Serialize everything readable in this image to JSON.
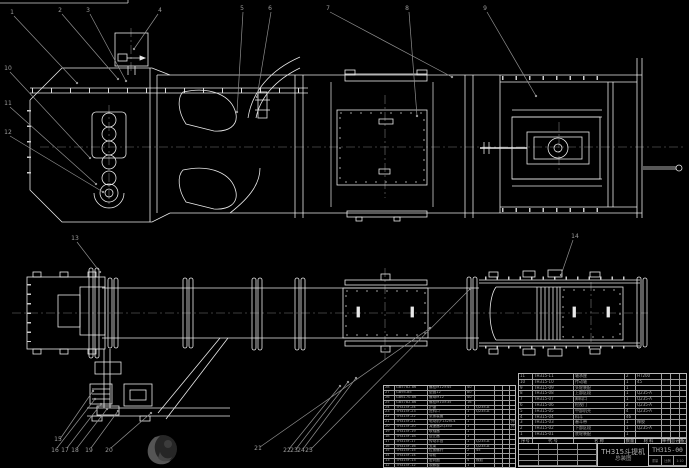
{
  "app": {
    "kind": "CAD assembly drawing of bucket elevator",
    "background": "#000000"
  },
  "drawing": {
    "title": "TH315斗提机",
    "subtitle": "总装图",
    "drawing_no": "TH315-00",
    "scale_rows": [
      [
        "重量",
        "比例",
        "1:10"
      ]
    ]
  },
  "bom_right": {
    "header_rows": [
      [
        "序号",
        "代 号",
        "名 称",
        "数量",
        "材 料",
        "单件",
        "总计",
        "备注"
      ]
    ],
    "rows": [
      [
        "11",
        "TH315-11",
        "轴承座",
        "2",
        "HT200",
        "",
        "",
        ""
      ],
      [
        "10",
        "TH315-10",
        "传动轴",
        "1",
        "45",
        "",
        "",
        ""
      ],
      [
        "9",
        "TH315-09",
        "头轮装配",
        "1",
        "",
        "",
        "",
        ""
      ],
      [
        "8",
        "TH315-08",
        "上部区段",
        "1",
        "Q235-A",
        "",
        "",
        ""
      ],
      [
        "7",
        "TH315-07",
        "卸料口",
        "1",
        "Q235-A",
        "",
        "",
        ""
      ],
      [
        "6",
        "TH315-06",
        "检视门",
        "2",
        "Q235-A",
        "",
        "",
        ""
      ],
      [
        "5",
        "TH315-05",
        "中部机壳",
        "4",
        "Q235-A",
        "",
        "",
        ""
      ],
      [
        "4",
        "TH315-04",
        "料斗",
        "46",
        "",
        "",
        "",
        ""
      ],
      [
        "3",
        "TH315-03",
        "畚斗带",
        "1",
        "橡胶",
        "",
        "",
        ""
      ],
      [
        "2",
        "TH315-02",
        "下部区段",
        "1",
        "Q235-A",
        "",
        "",
        ""
      ],
      [
        "1",
        "TH315-01",
        "底轮装配",
        "1",
        "",
        "",
        "",
        ""
      ]
    ]
  },
  "bom_left": {
    "rows": [
      [
        "28",
        "GB5782-86",
        "螺栓M12×45",
        "40",
        "",
        "",
        "",
        ""
      ],
      [
        "27",
        "GB95-85",
        "垫圈12",
        "80",
        "",
        "",
        "",
        ""
      ],
      [
        "26",
        "GB6170-86",
        "螺母M12",
        "40",
        "",
        "",
        "",
        ""
      ],
      [
        "25",
        "GB5782-86",
        "螺栓M10×35",
        "16",
        "",
        "",
        "",
        ""
      ],
      [
        "24",
        "TH315F-24",
        "护罩",
        "1",
        "Q235-A",
        "",
        "",
        ""
      ],
      [
        "23",
        "TH315F-23",
        "进料口",
        "1",
        "Q235-A",
        "",
        "",
        ""
      ],
      [
        "22",
        "TH315F-22",
        "张紧装置",
        "1",
        "",
        "",
        "",
        ""
      ],
      [
        "21",
        "TH315F-21",
        "电动机Y132M-4",
        "1",
        "",
        "",
        "",
        "外购"
      ],
      [
        "20",
        "TH315F-20",
        "减速器ZQ350",
        "1",
        "",
        "",
        "",
        "外购"
      ],
      [
        "19",
        "TH315F-19",
        "联轴器",
        "1",
        "",
        "",
        "",
        ""
      ],
      [
        "18",
        "TH315F-18",
        "逆止器",
        "1",
        "",
        "",
        "",
        ""
      ],
      [
        "17",
        "TH315F-17",
        "传动平台",
        "1",
        "Q235-A",
        "",
        "",
        ""
      ],
      [
        "16",
        "TH315F-16",
        "支架",
        "2",
        "Q235-A",
        "",
        "",
        ""
      ],
      [
        "15",
        "TH315F-15",
        "拉紧螺杆",
        "2",
        "45",
        "",
        "",
        ""
      ],
      [
        "14",
        "TH315F-14",
        "导轮",
        "2",
        "",
        "",
        "",
        ""
      ],
      [
        "13",
        "TH315F-13",
        "密封圈",
        "4",
        "橡胶",
        "",
        "",
        ""
      ],
      [
        "12",
        "TH315F-12",
        "观察窗",
        "1",
        "",
        "",
        "",
        ""
      ]
    ]
  },
  "callouts": [
    "1",
    "2",
    "3",
    "4",
    "5",
    "6",
    "7",
    "8",
    "9",
    "10",
    "11",
    "12",
    "13",
    "14",
    "15",
    "16",
    "17",
    "18",
    "19",
    "20",
    "21",
    "22",
    "23",
    "24",
    "25"
  ],
  "colors": {
    "line": "#e9e9e9",
    "centerline": "#787878",
    "leader": "#8f8f8f",
    "table_line": "#c0c0c0"
  }
}
